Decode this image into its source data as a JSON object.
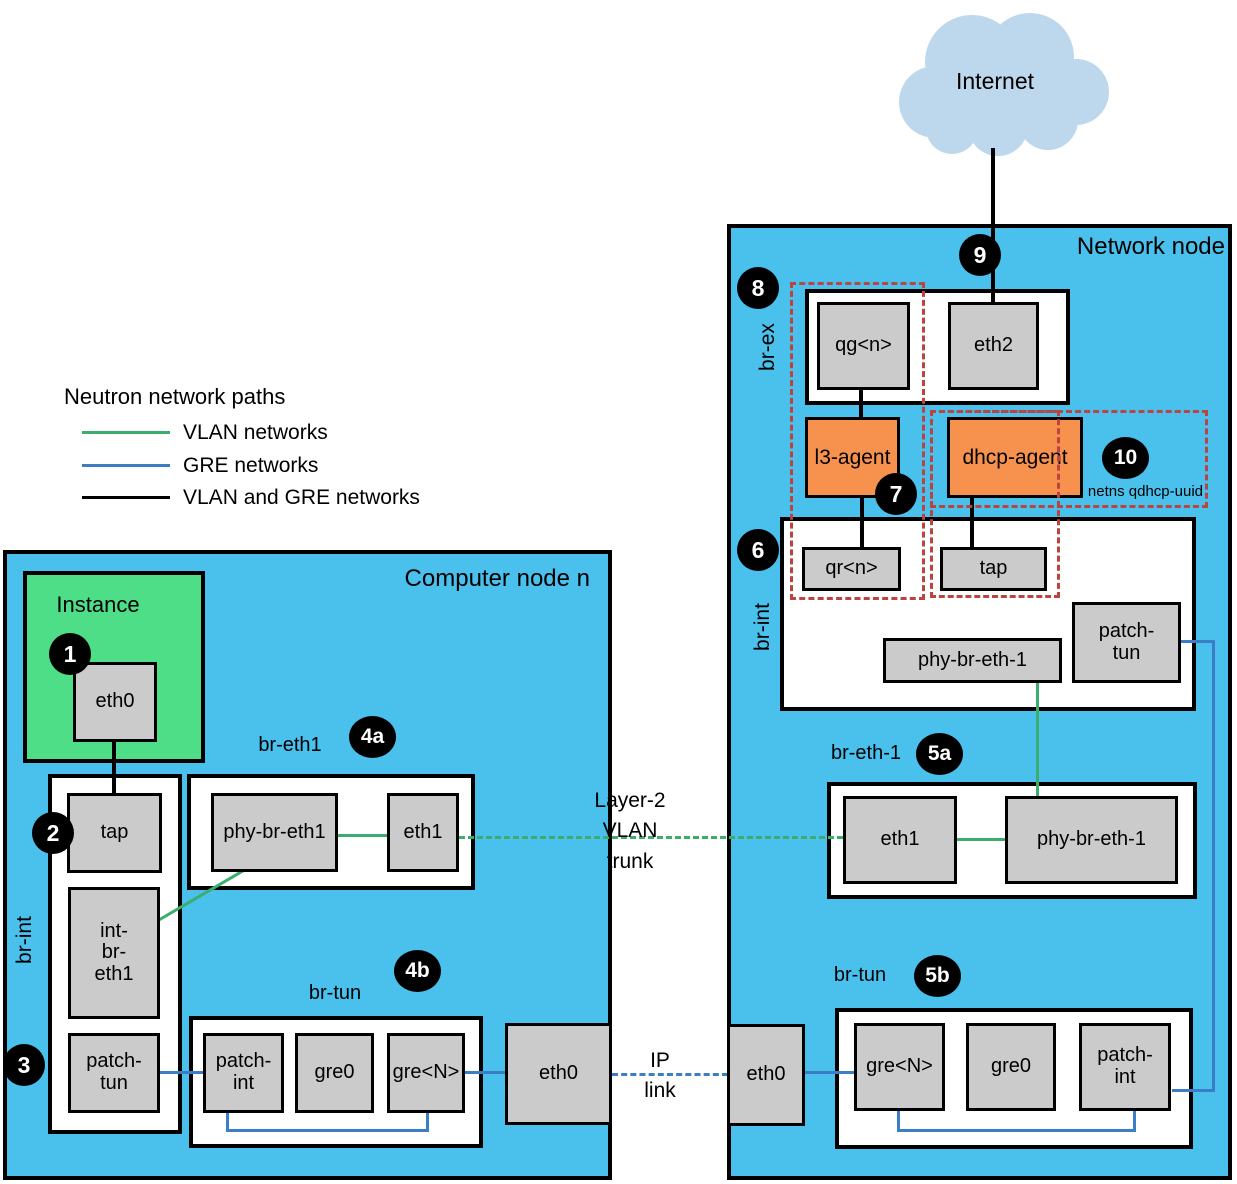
{
  "colors": {
    "node_bg": "#4AC0EC",
    "instance_bg": "#4DDE87",
    "port_bg": "#CBCBCB",
    "agent_bg": "#F6914E",
    "netns_dash": "#BC4440",
    "vlan_line": "#3BAE6E",
    "gre_line": "#3B7EC5",
    "vlan_gre_line": "#000000",
    "cloud": "#BDD8EC"
  },
  "legend": {
    "title": "Neutron network paths",
    "items": [
      {
        "label": "VLAN networks",
        "color": "#3BAE6E"
      },
      {
        "label": "GRE networks",
        "color": "#3B7EC5"
      },
      {
        "label": "VLAN and GRE networks",
        "color": "#000000"
      }
    ]
  },
  "internet": {
    "label": "Internet"
  },
  "links": {
    "vlan_trunk_label": "Layer-2\nVLAN\ntrunk",
    "ip_link_label": "IP\nlink"
  },
  "compute": {
    "title": "Computer node n",
    "instance": {
      "label": "Instance",
      "eth0": "eth0",
      "badge": "1"
    },
    "br_int": {
      "label": "br-int",
      "tap": "tap",
      "tap_badge": "2",
      "int_br_eth1": "int-\nbr-\neth1",
      "patch_tun": "patch-\ntun",
      "patch_badge": "3"
    },
    "br_eth1": {
      "label": "br-eth1",
      "badge": "4a",
      "phy": "phy-br-eth1",
      "eth1": "eth1"
    },
    "br_tun": {
      "label": "br-tun",
      "badge": "4b",
      "patch_int": "patch-\nint",
      "gre0": "gre0",
      "greN": "gre<N>"
    },
    "eth0": "eth0"
  },
  "network": {
    "title": "Network node",
    "internet_badge": "9",
    "br_ex": {
      "label": "br-ex",
      "badge": "8",
      "qg": "qg<n>",
      "eth2": "eth2"
    },
    "agents": {
      "l3": "l3-agent",
      "l3_badge": "7",
      "dhcp": "dhcp-agent",
      "dhcp_badge": "10",
      "netns_label": "netns qdhcp-uuid"
    },
    "br_int": {
      "label": "br-int",
      "badge": "6",
      "qr": "qr<n>",
      "tap": "tap",
      "phy": "phy-br-eth-1",
      "patch_tun": "patch-\ntun"
    },
    "br_eth1": {
      "label": "br-eth-1",
      "badge": "5a",
      "eth1": "eth1",
      "phy": "phy-br-eth-1"
    },
    "br_tun": {
      "label": "br-tun",
      "badge": "5b",
      "greN": "gre<N>",
      "gre0": "gre0",
      "patch_int": "patch-\nint"
    },
    "eth0": "eth0"
  }
}
